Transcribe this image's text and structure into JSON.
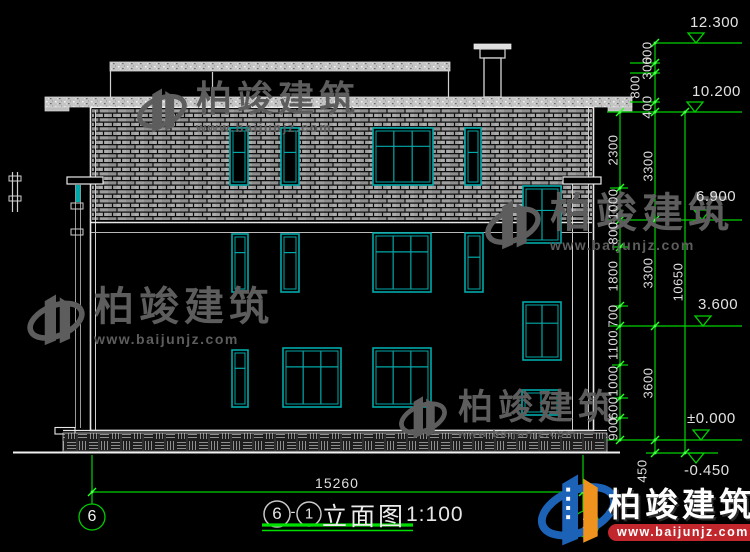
{
  "drawing": {
    "title": {
      "axis_a": "6",
      "separator": "-",
      "axis_b": "1",
      "name": "立面图",
      "scale": "1:100"
    },
    "grid_bubbles": {
      "left": "6",
      "right": "1"
    },
    "levels": {
      "l1": "12.300",
      "l2": "10.200",
      "l3": "6.900",
      "l4": "3.600",
      "l5": "±0.000",
      "l6": "-0.450"
    },
    "dims": {
      "overall_width": "15260",
      "total_height": "10650",
      "foundation": "450",
      "top_chain": [
        "600",
        "300",
        "800",
        "400"
      ],
      "floor_chain": [
        "3300",
        "3300",
        "3600"
      ],
      "fine_chain": [
        "2300",
        "1000",
        "800",
        "1800",
        "700",
        "1100",
        "1000",
        "600",
        "900"
      ]
    }
  },
  "watermark": {
    "brand": "柏竣建筑",
    "url": "www.baijunjz.com"
  },
  "brand_logo": {
    "brand": "柏竣建筑",
    "url": "www.baijunjz.com"
  },
  "colors": {
    "background": "#000000",
    "drawing_white": "#e8e8e8",
    "brick_gray": "#9e9e9e",
    "window_teal": "#00a9a9",
    "dimension_green": "#00d400",
    "logo_blue": "#1c63b7",
    "logo_orange": "#f0921e",
    "logo_red": "#c1272d"
  }
}
